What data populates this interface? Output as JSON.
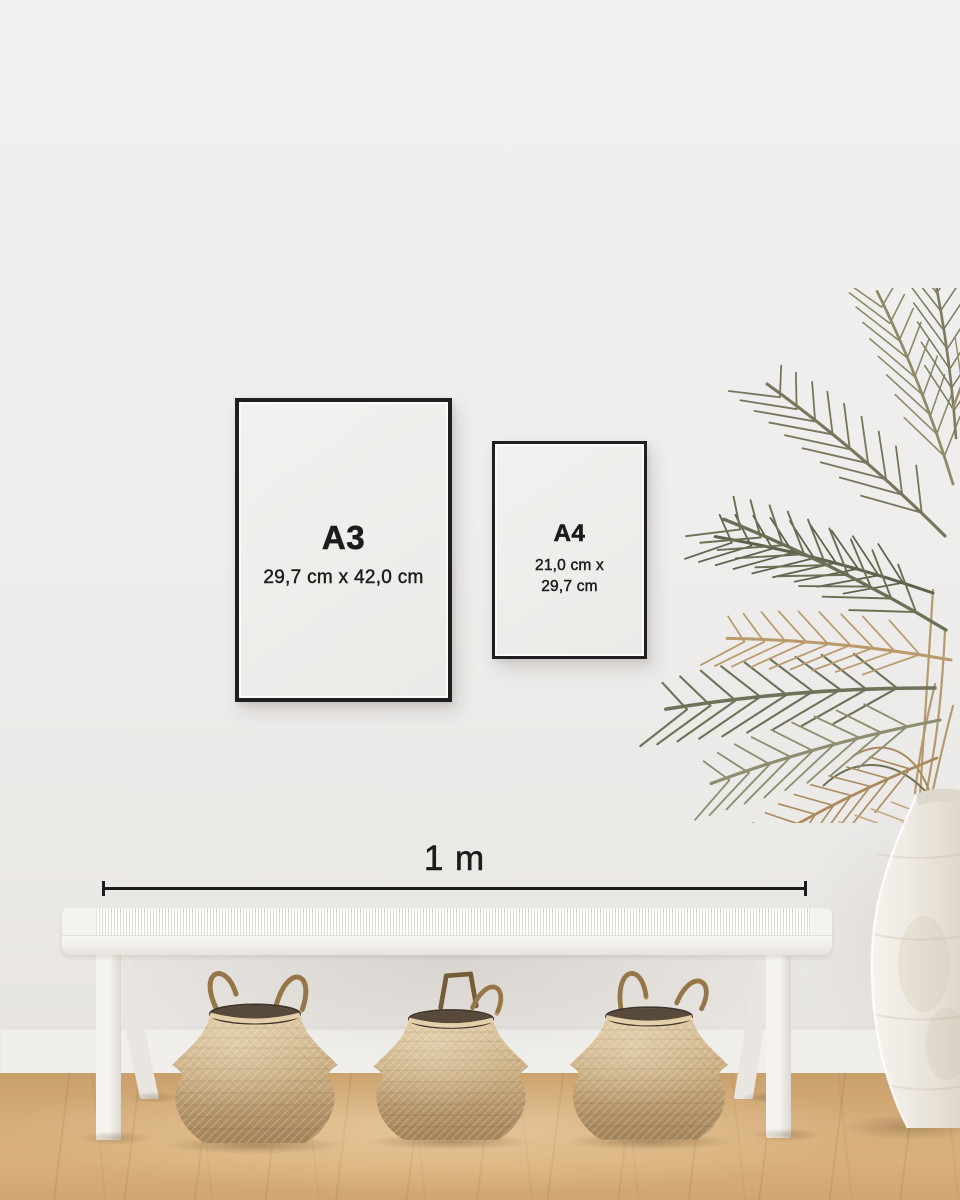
{
  "scene": {
    "description": "Bright interior wall with two black-framed poster size mockups, a dried palm in a white ceramic floor vase, and a white woven bench over three seagrass belly baskets on a light oak floor",
    "colors": {
      "wall": "#efefee",
      "baseboard": "#f1efec",
      "floor_wood": "#d6ae7c",
      "frame": "#1f1f21",
      "paper": "#f1f0ee",
      "text": "#1c1c1c",
      "bench": "#f5f3f0",
      "basket": "#c5a87c",
      "vase": "#ece8e1",
      "leaf_green": "#6b7055",
      "leaf_brown": "#ab8a5e"
    }
  },
  "posters": [
    {
      "label": "A3",
      "size_lines": [
        "29,7 cm x 42,0 cm"
      ]
    },
    {
      "label": "A4",
      "size_lines": [
        "21,0 cm x",
        "29,7 cm"
      ]
    }
  ],
  "measurement": {
    "label": "1 m"
  },
  "decor": {
    "plant": "dried-palm-leaves",
    "vase": "white-ceramic-floor-vase",
    "bench": "white-woven-bench",
    "baskets": [
      "seagrass-belly-basket",
      "seagrass-belly-basket",
      "seagrass-belly-basket"
    ]
  }
}
